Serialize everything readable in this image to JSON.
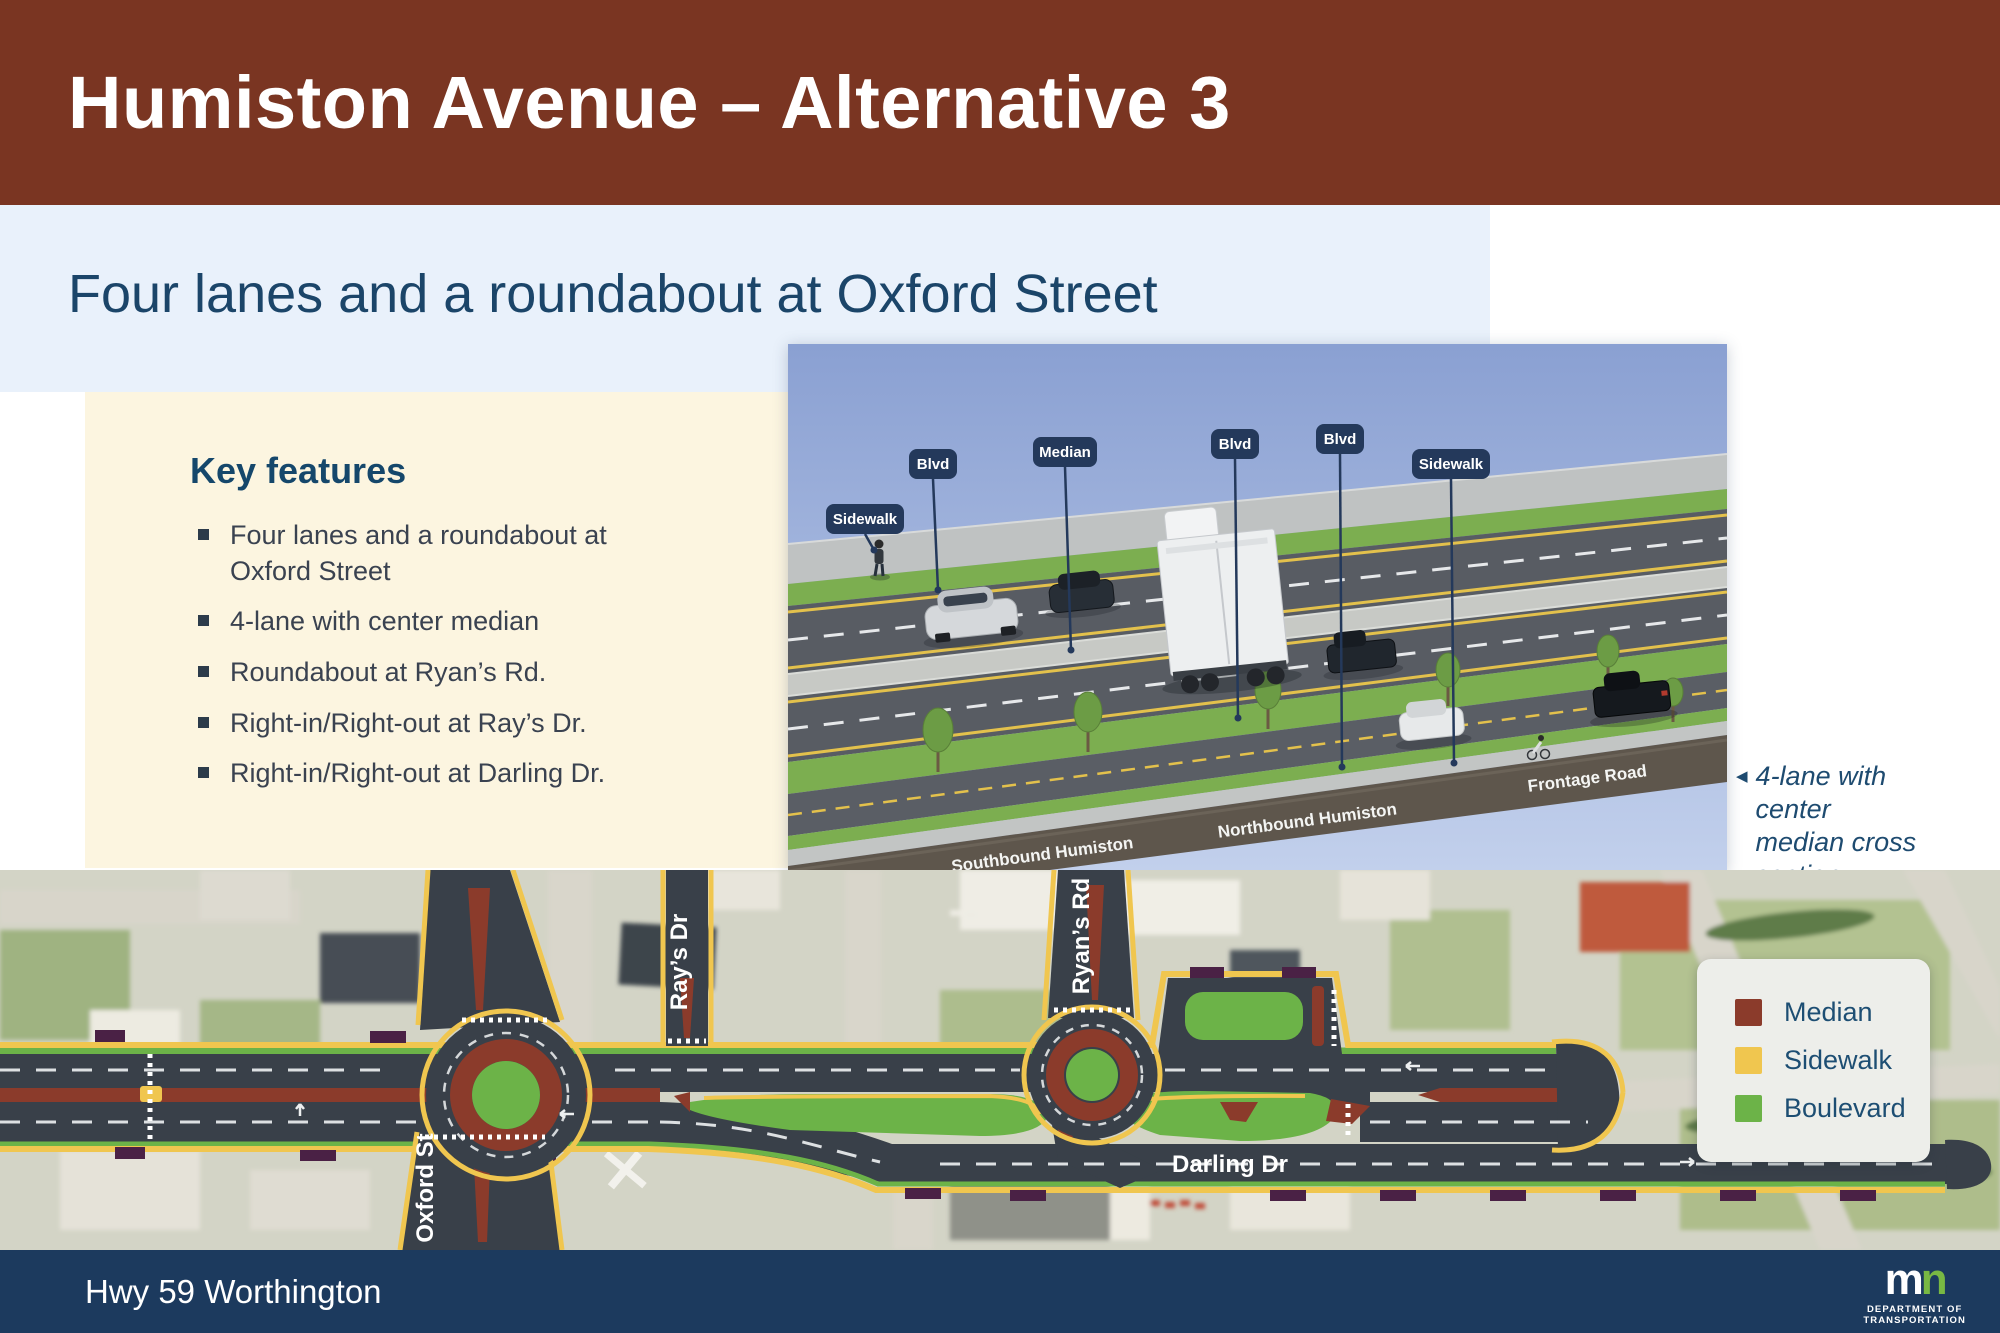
{
  "header": {
    "title": "Humiston Avenue – Alternative 3"
  },
  "subtitle": {
    "text": "Four lanes and a roundabout at Oxford Street"
  },
  "key_features": {
    "heading": "Key features",
    "bullets": [
      "Four lanes and a roundabout at Oxford Street",
      "4-lane with center median",
      "Roundabout at Ryan’s Rd.",
      "Right-in/Right-out at Ray’s Dr.",
      "Right-in/Right-out at Darling Dr."
    ]
  },
  "cross_section": {
    "labels": {
      "sidewalk_left": "Sidewalk",
      "blvd_left": "Blvd",
      "median": "Median",
      "blvd_mid": "Blvd",
      "blvd_right": "Blvd",
      "sidewalk_right": "Sidewalk"
    },
    "road_names": {
      "southbound": "Southbound Humiston",
      "northbound": "Northbound Humiston",
      "frontage": "Frontage Road"
    },
    "caption": {
      "arrow": "◀",
      "text": "4-lane with center median cross section"
    }
  },
  "map": {
    "street_labels": {
      "oxford": "Oxford St",
      "rays": "Ray’s Dr",
      "ryans": "Ryan’s Rd",
      "darling": "Darling Dr"
    },
    "legend": {
      "items": [
        {
          "label": "Median",
          "color": "#8B3B2B"
        },
        {
          "label": "Sidewalk",
          "color": "#F0C64F"
        },
        {
          "label": "Boulevard",
          "color": "#6CB348"
        }
      ]
    }
  },
  "footer": {
    "location": "Hwy 59 Worthington",
    "logo": {
      "m": "m",
      "n": "n",
      "line1": "DEPARTMENT OF",
      "line2": "TRANSPORTATION"
    }
  },
  "colors": {
    "header_brown": "#7A3522",
    "band_blue": "#E9F1FB",
    "cream": "#FCF5E0",
    "heading_navy": "#15476B",
    "subtitle_navy": "#1B4569",
    "footer_navy": "#1C3A5E",
    "map_road": "#394049",
    "logo_green": "#78B843"
  }
}
